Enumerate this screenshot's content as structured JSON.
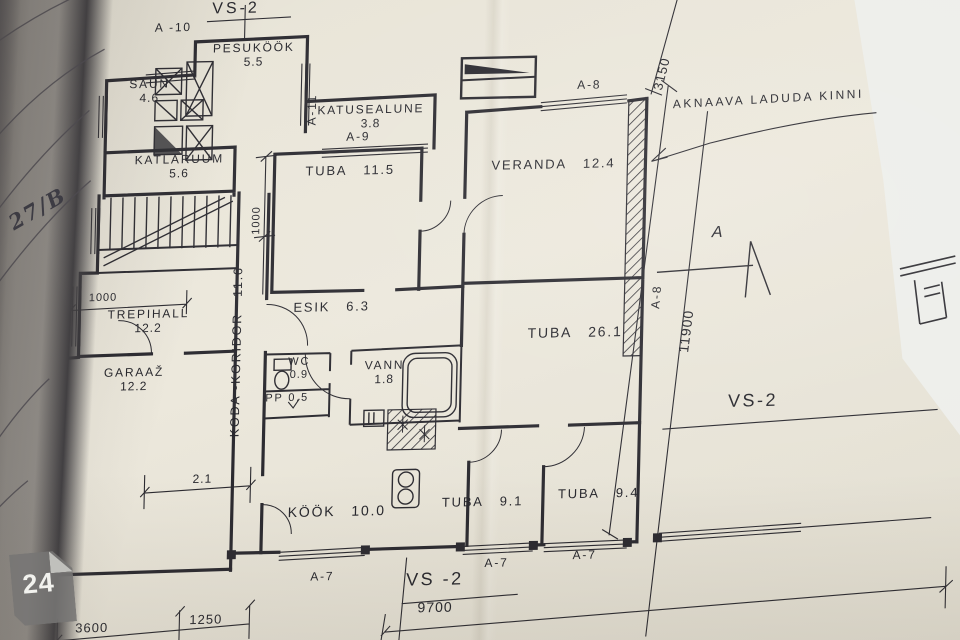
{
  "photo": {
    "handwriting": "27/B",
    "page_badge": "24"
  },
  "plan": {
    "annotation": "AKNAAVA LADUDA KINNI",
    "ink_color": "#2b2a30",
    "paper_color": "#e9e5d9",
    "rooms": {
      "pesukook": {
        "name": "PESUKÖÖK",
        "area": "5.5"
      },
      "saun": {
        "name": "SAUN",
        "area": "4.6"
      },
      "katlaruum": {
        "name": "KATLARUUM",
        "area": "5.6"
      },
      "katusealune": {
        "name": "KATUSEALUNE",
        "area": "3.8"
      },
      "tuba_115": {
        "name": "TUBA",
        "area": "11.5"
      },
      "trepihall": {
        "name": "TREPIHALL",
        "area": "12.2"
      },
      "koda_koridor": {
        "name": "KODA -KORIDOR",
        "area": "11.6"
      },
      "garaaz": {
        "name": "GARAAŽ",
        "area": "12.2"
      },
      "esik": {
        "name": "ESIK",
        "area": "6.3"
      },
      "wc": {
        "name": "WC",
        "area": "0.9"
      },
      "pp": {
        "name": "PP",
        "area": "0.5"
      },
      "vann": {
        "name": "VANN",
        "area": "1.8"
      },
      "veranda": {
        "name": "VERANDA",
        "area": "12.4"
      },
      "tuba_261": {
        "name": "TUBA",
        "area": "26.1"
      },
      "kook": {
        "name": "KÖÖK",
        "area": "10.0"
      },
      "tuba_91": {
        "name": "TUBA",
        "area": "9.1"
      },
      "tuba_94": {
        "name": "TUBA",
        "area": "9.4"
      }
    },
    "markers": {
      "vs2_top": "VS-2",
      "vs2_right": "VS-2",
      "vs2_bottom": "VS -2",
      "s2_left": "S -2",
      "a10_top": "A -10",
      "a10_left_1": "A-10",
      "a10_left_2": "A-10",
      "a10_left_3": "A-10",
      "a10_left_4": "A-10",
      "a11": "A-11",
      "a9": "A-9",
      "a8_top": "A-8",
      "a8_right": "A-8",
      "a7_1": "A-7",
      "a7_2": "A-7",
      "a7_3": "A-7",
      "section_a": "A"
    },
    "dimensions": {
      "d3150": "3150",
      "d11900": "11900",
      "d1000_h": "1000",
      "d1000_v": "1000",
      "d21": "2.1",
      "d3600": "3600",
      "d1250": "1250",
      "d9700": "9700"
    }
  }
}
